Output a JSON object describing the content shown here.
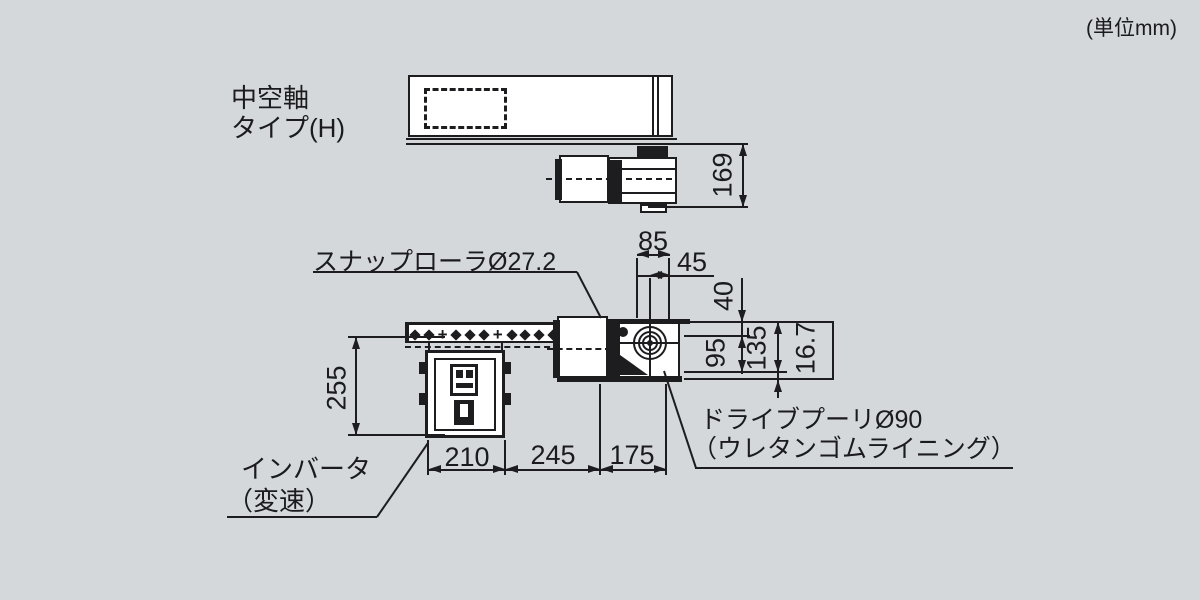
{
  "units_note": "(単位mm)",
  "type_label": {
    "line1": "中空軸",
    "line2": "タイプ(H)"
  },
  "callouts": {
    "snap_roller": "スナップローラØ27.2",
    "drive_pulley_line1": "ドライブプーリØ90",
    "drive_pulley_line2": "（ウレタンゴムライニング）",
    "inverter_line1": "インバータ",
    "inverter_line2": "（変速）"
  },
  "dims": {
    "d169": "169",
    "d85": "85",
    "d45": "45",
    "d40": "40",
    "d95": "95",
    "d135": "135",
    "d16_7": "16.7",
    "d255": "255",
    "d210": "210",
    "d245": "245",
    "d175": "175"
  },
  "colors": {
    "background": "#d4d8db",
    "line": "#1d1d20",
    "fill": "#ffffff"
  }
}
